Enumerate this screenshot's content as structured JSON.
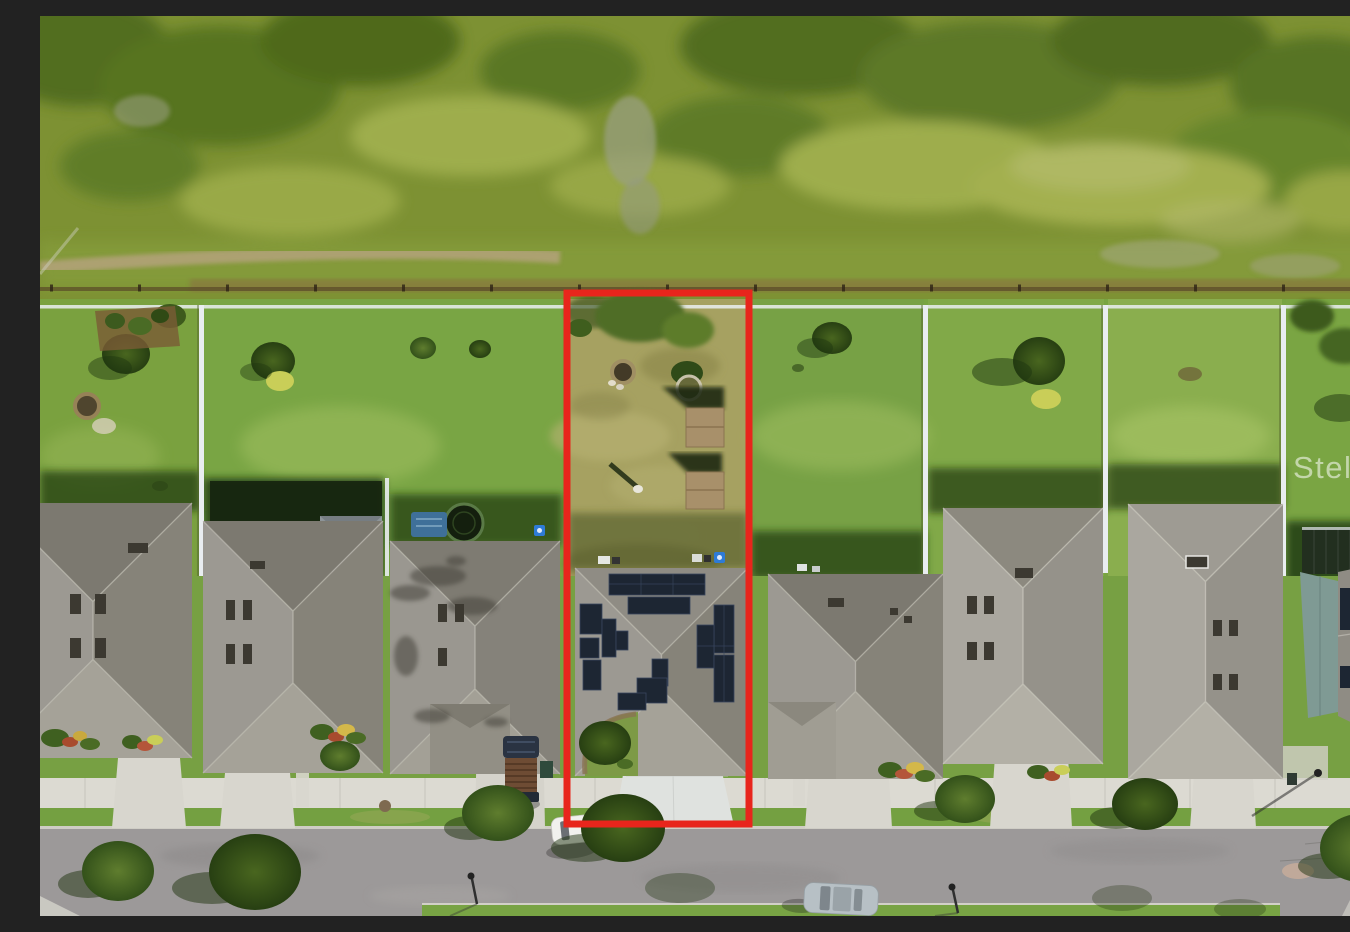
{
  "image": {
    "kind": "aerial-drone-photo",
    "width": 1350,
    "height": 900
  },
  "watermark": {
    "text": "Stellar MLS",
    "color": "rgba(255,255,255,0.55)"
  },
  "boundary": {
    "color": "#e8251c",
    "x": 527,
    "y": 277,
    "width": 182,
    "height": 531,
    "stroke_width": 7
  },
  "palette": {
    "field_green": "#7d9133",
    "yard_green": "#78a441",
    "dry_yard": "#a6a161",
    "sidewalk": "#dcdad2",
    "street": "#9c9999",
    "driveway_bright": "#dfe2df",
    "driveway": "#d8d6ce",
    "roof_gray": "#8f8c84",
    "roof_light": "#9e9b93",
    "solar_panel": "#1d2633",
    "white_fence": "#eaeef1",
    "shed_tan": "#a8906a",
    "tree_green": "#3f5e1e",
    "shadow_green": "#223c12",
    "pool_dark": "#16240f"
  },
  "scene": {
    "setting": "suburban single-family street backing onto open grassland",
    "highlighted_lot": {
      "yard": "dry lawn",
      "features": [
        "fire pit",
        "shed",
        "shed",
        "planter ring",
        "rooftop solar array",
        "wide driveway"
      ]
    },
    "houses_visible": 8,
    "vehicles": [
      "white car parked at curb",
      "silver car on street",
      "dark pickup truck in driveway"
    ],
    "yard_items": [
      "trampoline",
      "screened pool enclosure",
      "play mat",
      "fire pit",
      "garden beds"
    ],
    "street_items": [
      "sidewalk",
      "street lamps",
      "manhole covers",
      "street trees"
    ]
  }
}
